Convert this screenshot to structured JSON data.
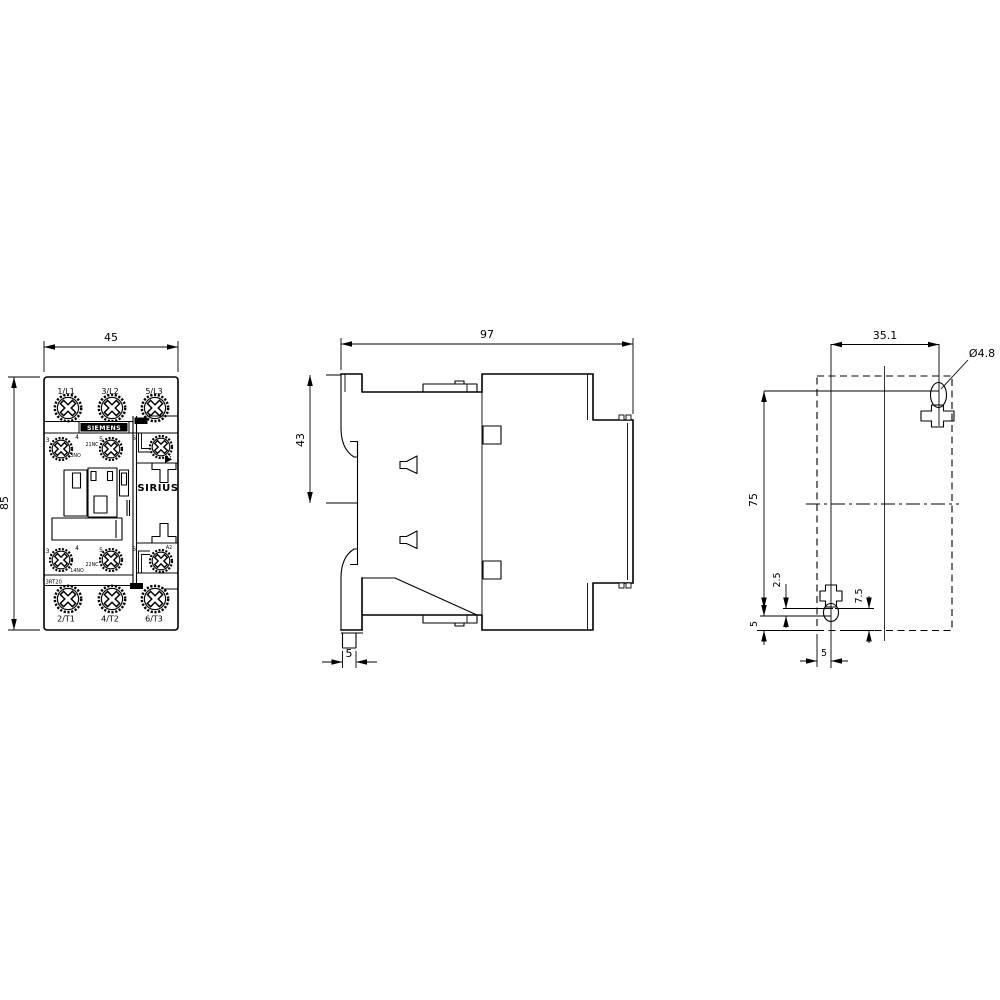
{
  "front_view": {
    "terminals_top": [
      "1/L1",
      "3/L2",
      "5/L3"
    ],
    "terminals_bottom": [
      "2/T1",
      "4/T2",
      "6/T3"
    ],
    "brand": "SIEMENS",
    "series": "SIRIUS",
    "type": "3RT20",
    "aux_digits_top": [
      "3",
      "4",
      "5",
      "6"
    ],
    "aux_digits_bottom": [
      "3",
      "4",
      "5",
      "6"
    ],
    "aux_labels_top": [
      "13NO",
      "21NC"
    ],
    "aux_labels_bottom": [
      "14NO",
      "22NC"
    ],
    "coil_top": "A1",
    "coil_bottom": "A2",
    "dim_width": "45",
    "dim_height": "85"
  },
  "side_view": {
    "dim_depth": "97",
    "dim_rail": "43",
    "dim_foot": "5"
  },
  "drill_plan": {
    "dim_spacing_x": "35.1",
    "dim_diameter": "Ø4.8",
    "dim_spacing_y": "75",
    "dim_offset_a": "2.5",
    "dim_offset_b": "7.5",
    "dim_offset_c": "5",
    "dim_offset_d": "5"
  },
  "colors": {
    "line": "#000000",
    "background": "#ffffff"
  }
}
